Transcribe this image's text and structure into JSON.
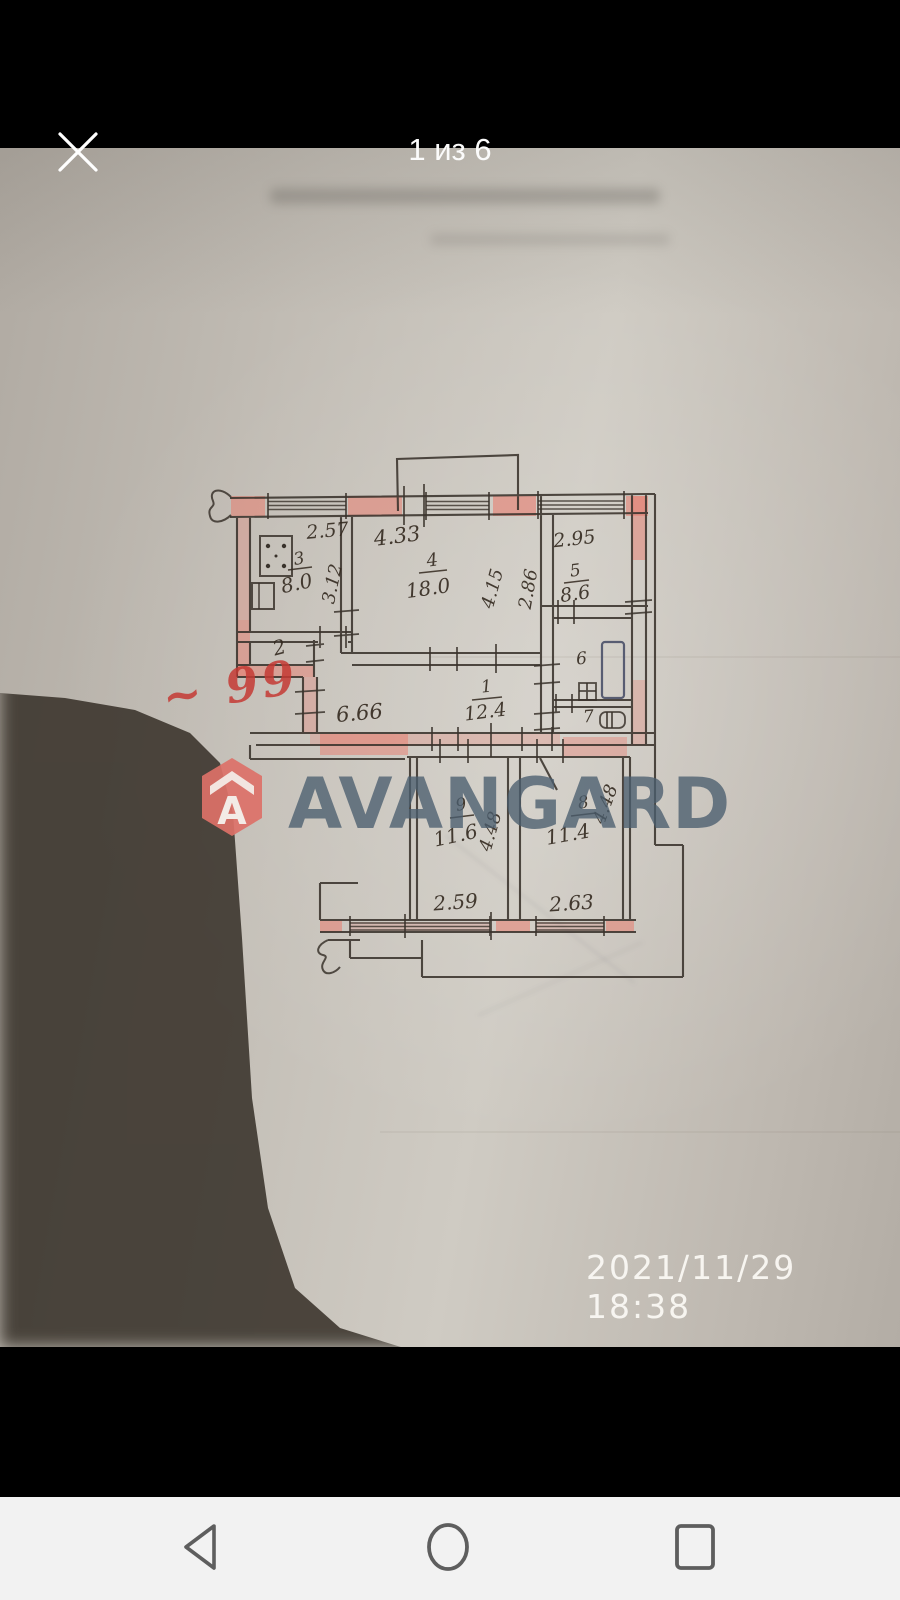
{
  "header": {
    "title": "1 из 6"
  },
  "icons": {
    "close": "close-x",
    "back": "triangle-left-outline",
    "home": "circle-outline",
    "recents": "square-outline"
  },
  "photo": {
    "timestamp": "2021/11/29  18:38",
    "watermark": "AVANGARD",
    "note": "~ 99",
    "plan": {
      "rooms": {
        "r3": {
          "num": "3",
          "area": "8.0"
        },
        "r4": {
          "num": "4",
          "area": "18.0"
        },
        "r5": {
          "num": "5",
          "area": "8.6"
        },
        "r1": {
          "num": "1",
          "area": "12.4"
        },
        "r2": {
          "num": "2"
        },
        "r6": {
          "num": "6"
        },
        "r7": {
          "num": "7"
        },
        "r9": {
          "num": "9",
          "area": "11.6"
        },
        "r8": {
          "num": "8",
          "area": "11.4"
        }
      },
      "dims": {
        "top_left": "2.57",
        "top_mid": "4.33",
        "top_right": "2.95",
        "r3_depth": "3.12",
        "r4_depth": "4.15",
        "r5_depth": "2.86",
        "hall": "6.66",
        "r9_depth": "4.48",
        "r8_depth": "4.48",
        "bottom_left": "2.59",
        "bottom_right": "2.63"
      }
    }
  }
}
